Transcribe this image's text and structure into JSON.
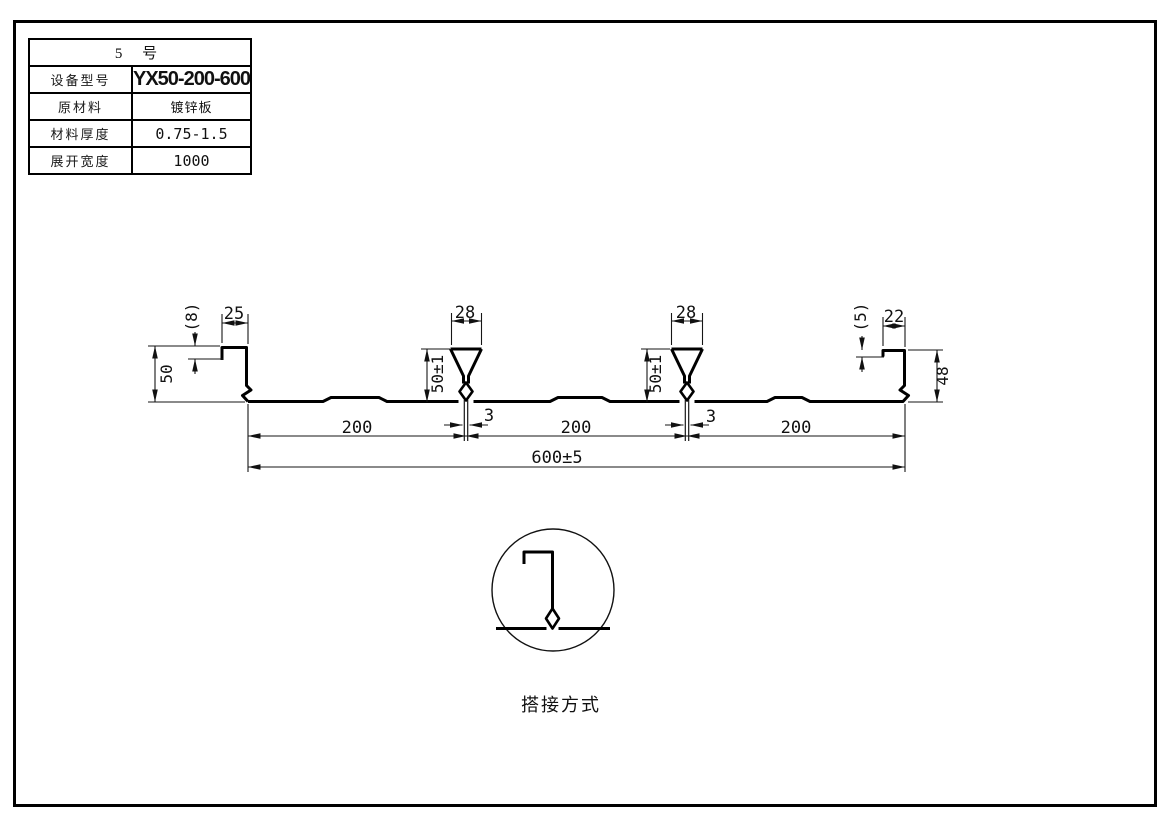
{
  "sheet": {
    "bg": "#ffffff",
    "line_color": "#000000"
  },
  "spec_table": {
    "title": "5 号",
    "rows": [
      {
        "label": "设备型号",
        "value": "YX50-200-600"
      },
      {
        "label": "原材料",
        "value": "镀锌板"
      },
      {
        "label": "材料厚度",
        "value": "0.75-1.5"
      },
      {
        "label": "展开宽度",
        "value": "1000"
      }
    ]
  },
  "drawing": {
    "dims": {
      "span_left": "200",
      "span_mid": "200",
      "span_right": "200",
      "overall": "600±5",
      "rib_top_width": "28",
      "rib_height": "50±1",
      "rib_slot": "3",
      "left_lip": "25",
      "left_lip_hook": "(8)",
      "left_leg_height": "50",
      "right_lip": "22",
      "right_lip_hook": "(5)",
      "right_leg_height": "48"
    },
    "detail_label": "搭接方式"
  }
}
